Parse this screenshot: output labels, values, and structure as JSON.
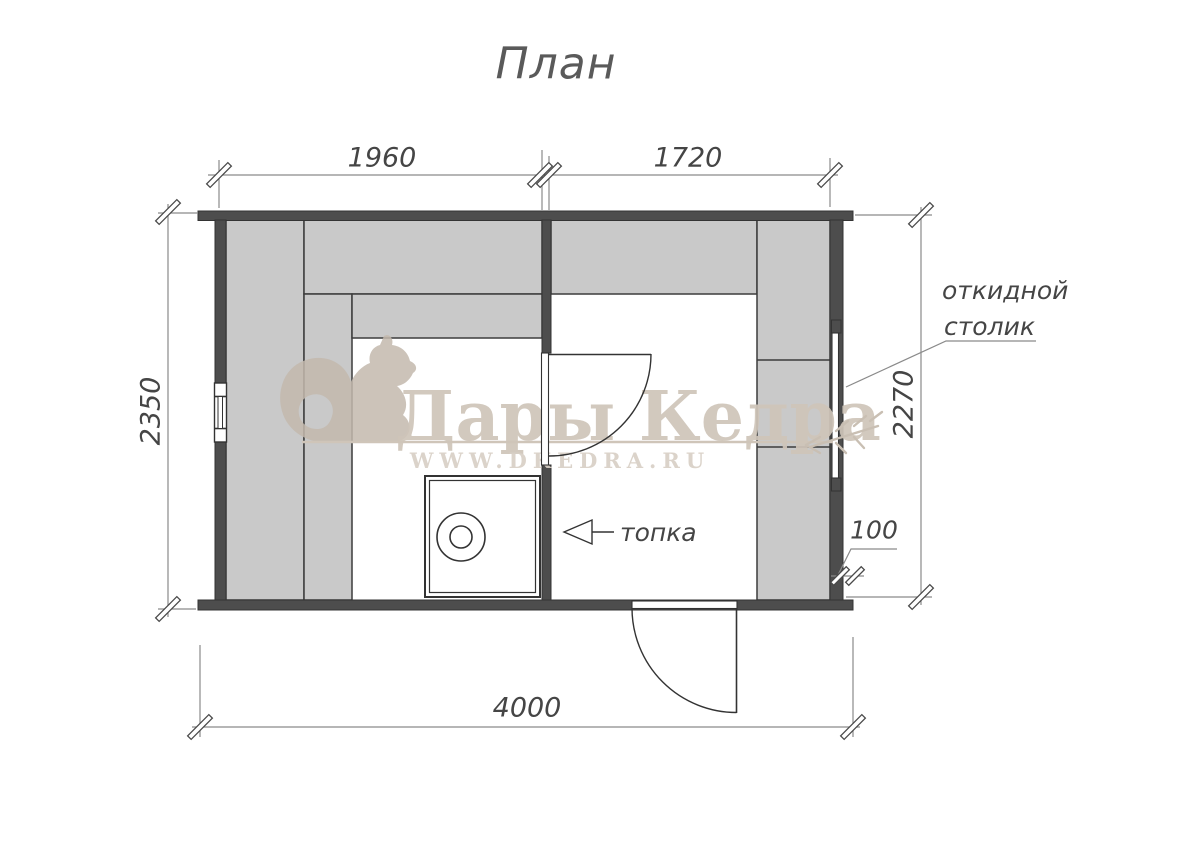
{
  "title": "План",
  "dimensions": {
    "top_left_width": "1960",
    "top_right_width": "1720",
    "left_height": "2350",
    "right_height": "2270",
    "total_width": "4000",
    "wall_offset": "100"
  },
  "labels": {
    "folding_table_line1": "откидной",
    "folding_table_line2": "столик",
    "firebox": "топка"
  },
  "watermark": {
    "brand": "Дары Кедра",
    "website": "WWW.DKEDRA.RU"
  },
  "colors": {
    "wall": "#4d4d4d",
    "bench_fill": "#c9c9c9",
    "drawing_line": "#333333",
    "dimension_line": "#8a8a8a",
    "dimension_text": "#454545",
    "watermark_beige": "#cdc3b7"
  }
}
